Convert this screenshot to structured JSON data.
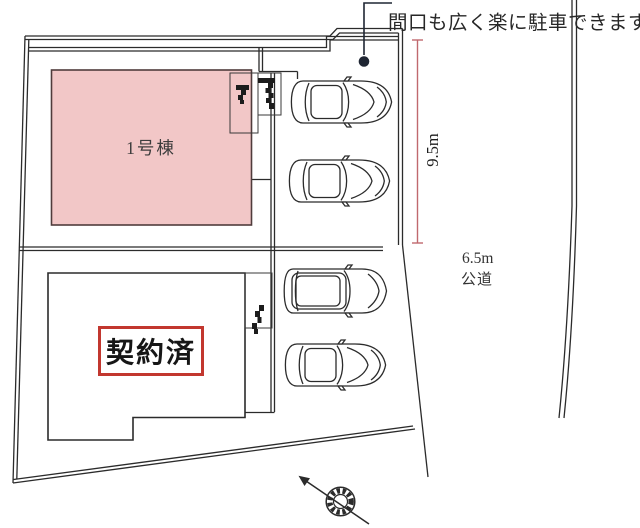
{
  "plan": {
    "annotation": "間口も広く楽に駐車できます",
    "unit1_label": "1号棟",
    "unit2_status_label": "契約済",
    "frontage_dimension": "9.5m",
    "road_width": "6.5m",
    "road_type": "公道"
  },
  "colors": {
    "unit1_fill": "#f2c7c7",
    "sold_box_border": "#c2372f",
    "dimension_red": "#c0696e",
    "ink": "#2b2b2b"
  },
  "icons": {
    "compass": "compass-north-icon",
    "callout_dot": "callout-marker-dot",
    "car": "car-top-view-icon"
  }
}
